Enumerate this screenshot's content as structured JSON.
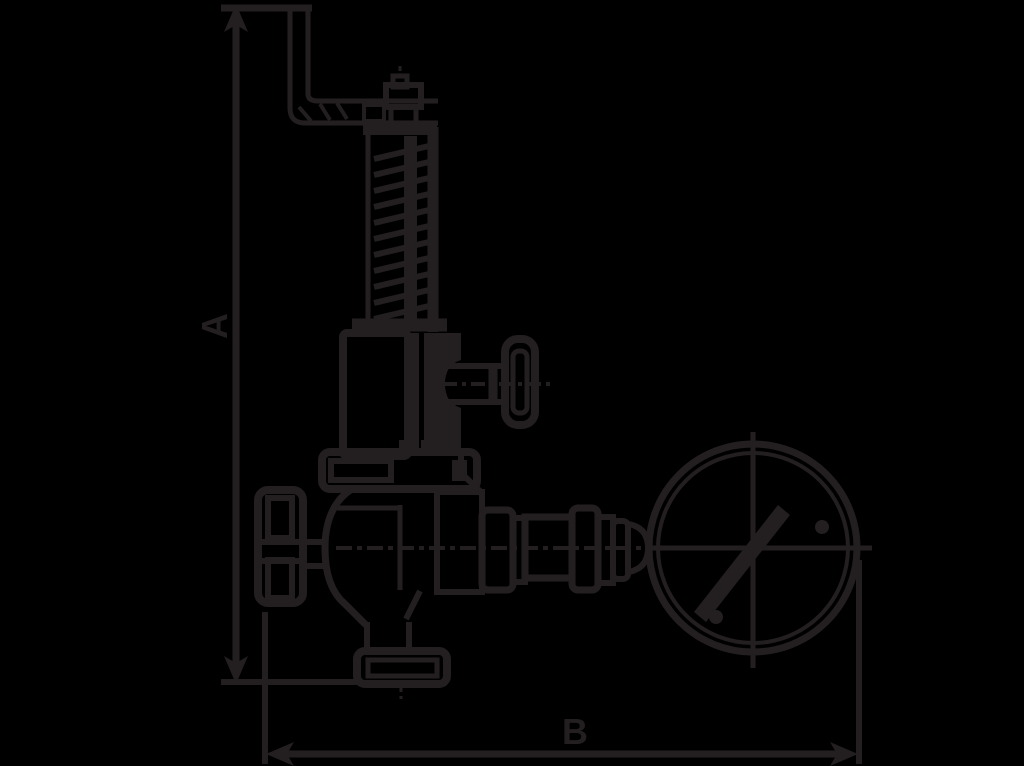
{
  "image_type": "technical-dimension-drawing",
  "subject": "Safety relief valve with lifting lever, gag knob, spring bonnet and pressure gauge, annotated with overall height and width dimensions",
  "colors": {
    "background": "#000000",
    "ink": "#231f20"
  },
  "dimensions": {
    "a": {
      "label": "A",
      "orientation": "vertical",
      "measures": "overall height from lever top to outlet flange"
    },
    "b": {
      "label": "B",
      "orientation": "horizontal",
      "measures": "overall width from inlet flange to gauge edge"
    }
  },
  "components": {
    "lever": "lifting-lever",
    "cap": "spindle-cap",
    "spring": "spring-column",
    "bonnet": "bonnet-yoke",
    "knob": "gag-knob",
    "flange": "bonnet-flange",
    "body": "valve-body",
    "inlet": "inlet-end-flange",
    "outlet": "bottom-outlet-flange",
    "fittings": "gauge-connection-fittings",
    "gauge": "pressure-gauge-dial"
  }
}
